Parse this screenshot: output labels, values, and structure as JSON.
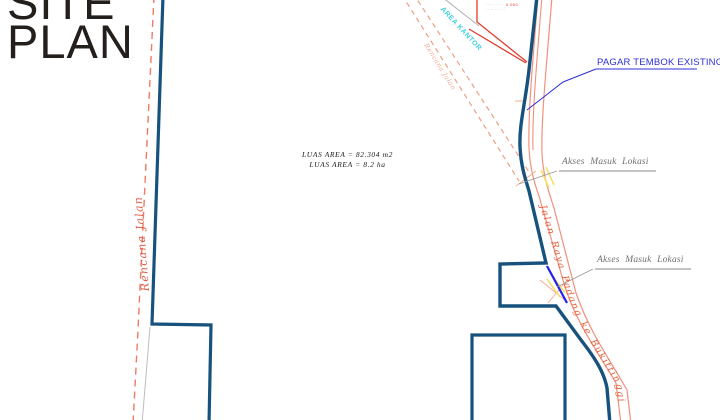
{
  "title": {
    "line1": "SITE",
    "line2": "PLAN"
  },
  "area_note": {
    "line1": "LUAS AREA = 82.304 m2",
    "line2": "LUAS AREA = 8.2 ha"
  },
  "labels": {
    "pagar_tembok": "PAGAR TEMBOK EXISTING",
    "akses_masuk_1": "Akses Masuk Lokasi",
    "akses_masuk_2": "Akses Masuk Lokasi",
    "jalan_raya": "Jalan Raya Padang ke Bukittinggi",
    "rencana_jalan": "Rencana Jalan",
    "side_road": "Rencana Jalan",
    "area_cyan": "AREA KANTOR",
    "tiny_note_left": "····· ····",
    "tiny_note_red": "0.000",
    "tiny_note_line2": "···· ··· ··"
  },
  "colors": {
    "boundary_blue": "#17527e",
    "access_blue": "#2121ef",
    "road_red": "#f0907c",
    "dashed_red": "#f07a62",
    "bright_red": "#e23b2c",
    "label_blue": "#2f2fd8",
    "annotation_gray": "#70706e",
    "leader_gray": "#999999",
    "road_text_orange": "#e85d3a",
    "highlight_yellow": "#f3e26b",
    "area_cyan": "#3ecfe0"
  }
}
